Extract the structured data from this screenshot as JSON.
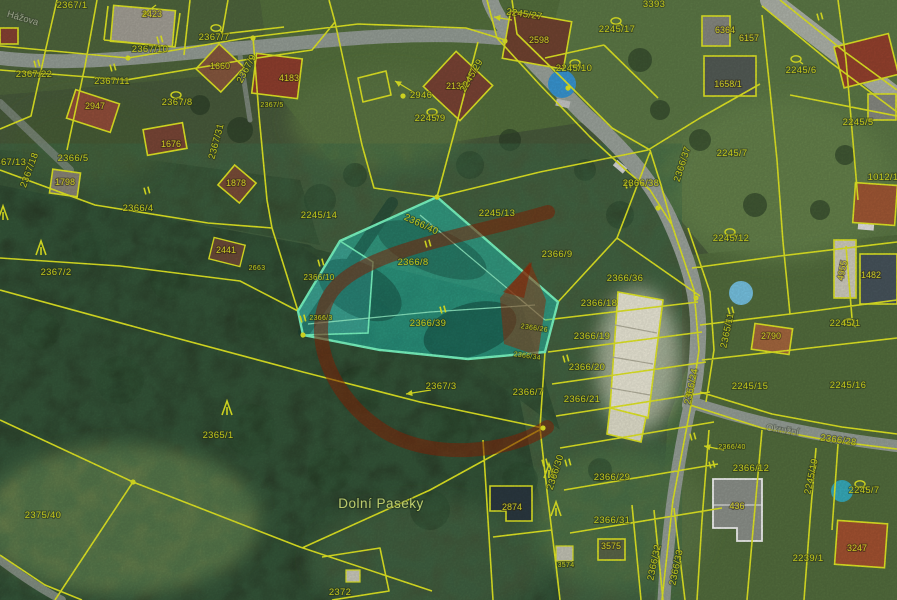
{
  "map": {
    "title": "Cadastral parcel map over aerial photo",
    "place_label": {
      "t": "Dolní Paseky",
      "x": 381,
      "y": 508
    },
    "street_labels": [
      {
        "t": "Hážova",
        "x": 22,
        "y": 21,
        "r": 16
      },
      {
        "t": "Okružní",
        "x": 782,
        "y": 433,
        "r": 9
      }
    ],
    "highlight": {
      "parcels": [
        "2366/8",
        "2366/39",
        "2366/40",
        "2366/10"
      ],
      "fill": "#1fe2d3",
      "stroke": "#7dffc8"
    },
    "colors": {
      "parcel_line": "#e9ef25",
      "parcel_text": "#dbe01f",
      "annotation_red": "#8c2405",
      "road_gray": "#9aa39b"
    },
    "parcel_labels": [
      {
        "t": "2367/1",
        "x": 72,
        "y": 8
      },
      {
        "t": "2423",
        "x": 152,
        "y": 17,
        "c": "b"
      },
      {
        "t": "2367/10",
        "x": 150,
        "y": 52
      },
      {
        "t": "2367/7",
        "x": 214,
        "y": 40
      },
      {
        "t": "2367/22",
        "x": 34,
        "y": 77
      },
      {
        "t": "2367/11",
        "x": 112,
        "y": 84
      },
      {
        "t": "2947",
        "x": 95,
        "y": 109,
        "c": "b"
      },
      {
        "t": "2367/8",
        "x": 177,
        "y": 105
      },
      {
        "t": "1660",
        "x": 220,
        "y": 69,
        "c": "b"
      },
      {
        "t": "4183",
        "x": 289,
        "y": 81,
        "c": "b"
      },
      {
        "t": "2367/5",
        "x": 272,
        "y": 107,
        "s": 7
      },
      {
        "t": "2367/9",
        "x": 249,
        "y": 70,
        "r": -62
      },
      {
        "t": "2367/31",
        "x": 219,
        "y": 142,
        "r": -75
      },
      {
        "t": "1676",
        "x": 171,
        "y": 147,
        "c": "b"
      },
      {
        "t": "2366/5",
        "x": 73,
        "y": 161
      },
      {
        "t": "1798",
        "x": 65,
        "y": 185,
        "c": "b"
      },
      {
        "t": "2367/13",
        "x": 8,
        "y": 165
      },
      {
        "t": "2367/18",
        "x": 32,
        "y": 171,
        "r": -70
      },
      {
        "t": "2366/4",
        "x": 138,
        "y": 211
      },
      {
        "t": "2367/2",
        "x": 56,
        "y": 275
      },
      {
        "t": "1878",
        "x": 236,
        "y": 186,
        "c": "b"
      },
      {
        "t": "2441",
        "x": 226,
        "y": 253,
        "c": "b"
      },
      {
        "t": "2663",
        "x": 257,
        "y": 270,
        "s": 7
      },
      {
        "t": "2365/1",
        "x": 218,
        "y": 438
      },
      {
        "t": "2375/40",
        "x": 43,
        "y": 518
      },
      {
        "t": "2245/27",
        "x": 524,
        "y": 17,
        "r": 8
      },
      {
        "t": "2598",
        "x": 539,
        "y": 43,
        "c": "b"
      },
      {
        "t": "2946",
        "x": 421,
        "y": 98
      },
      {
        "t": "2138",
        "x": 456,
        "y": 89,
        "c": "b"
      },
      {
        "t": "2245/29",
        "x": 474,
        "y": 77,
        "r": -60
      },
      {
        "t": "2245/9",
        "x": 430,
        "y": 121
      },
      {
        "t": "2245/10",
        "x": 574,
        "y": 71
      },
      {
        "t": "2245/13",
        "x": 497,
        "y": 216
      },
      {
        "t": "2245/14",
        "x": 319,
        "y": 218
      },
      {
        "t": "3393",
        "x": 654,
        "y": 7
      },
      {
        "t": "2245/17",
        "x": 617,
        "y": 32
      },
      {
        "t": "6364",
        "x": 725,
        "y": 33,
        "c": "b"
      },
      {
        "t": "6157",
        "x": 749,
        "y": 41,
        "c": "b"
      },
      {
        "t": "1658/1",
        "x": 728,
        "y": 87,
        "c": "b"
      },
      {
        "t": "2245/6",
        "x": 801,
        "y": 73
      },
      {
        "t": "2245/5",
        "x": 858,
        "y": 125
      },
      {
        "t": "1012/1",
        "x": 883,
        "y": 180
      },
      {
        "t": "2366/38",
        "x": 641,
        "y": 186
      },
      {
        "t": "2366/37",
        "x": 685,
        "y": 165,
        "r": -72
      },
      {
        "t": "2245/7",
        "x": 732,
        "y": 156
      },
      {
        "t": "2245/12",
        "x": 731,
        "y": 241
      },
      {
        "t": "2366/9",
        "x": 557,
        "y": 257
      },
      {
        "t": "2366/36",
        "x": 625,
        "y": 281
      },
      {
        "t": "2366/18",
        "x": 599,
        "y": 306
      },
      {
        "t": "2366/19",
        "x": 592,
        "y": 339
      },
      {
        "t": "2366/20",
        "x": 587,
        "y": 370
      },
      {
        "t": "2366/21",
        "x": 582,
        "y": 402
      },
      {
        "t": "2366/7",
        "x": 528,
        "y": 395
      },
      {
        "t": "2366/26",
        "x": 534,
        "y": 330,
        "r": 8,
        "s": 7
      },
      {
        "t": "2366/34",
        "x": 527,
        "y": 358,
        "r": 8,
        "s": 7
      },
      {
        "t": "2366/24",
        "x": 694,
        "y": 387,
        "r": -78
      },
      {
        "t": "2365/11",
        "x": 730,
        "y": 331,
        "r": -78
      },
      {
        "t": "2245/15",
        "x": 750,
        "y": 389
      },
      {
        "t": "2790",
        "x": 771,
        "y": 339,
        "c": "b"
      },
      {
        "t": "2245/16",
        "x": 848,
        "y": 388
      },
      {
        "t": "2245/1",
        "x": 845,
        "y": 326
      },
      {
        "t": "2366/40",
        "x": 420,
        "y": 227,
        "r": 25
      },
      {
        "t": "2366/8",
        "x": 413,
        "y": 265
      },
      {
        "t": "2366/39",
        "x": 428,
        "y": 326
      },
      {
        "t": "2366/10",
        "x": 319,
        "y": 280,
        "s": 8
      },
      {
        "t": "2366/3",
        "x": 321,
        "y": 320,
        "s": 7
      },
      {
        "t": "2367/3",
        "x": 441,
        "y": 389
      },
      {
        "t": "2366/29",
        "x": 612,
        "y": 480
      },
      {
        "t": "2366/31",
        "x": 612,
        "y": 523
      },
      {
        "t": "3575",
        "x": 611,
        "y": 549,
        "c": "b"
      },
      {
        "t": "3574",
        "x": 566,
        "y": 567,
        "s": 7
      },
      {
        "t": "2366/30",
        "x": 558,
        "y": 473,
        "r": -72
      },
      {
        "t": "2366/32",
        "x": 657,
        "y": 563,
        "r": -78
      },
      {
        "t": "2366/33",
        "x": 679,
        "y": 568,
        "r": -78
      },
      {
        "t": "2366/28",
        "x": 838,
        "y": 443,
        "r": 8
      },
      {
        "t": "2366/40",
        "x": 732,
        "y": 449,
        "s": 7
      },
      {
        "t": "2366/12",
        "x": 751,
        "y": 471
      },
      {
        "t": "436",
        "x": 737,
        "y": 509,
        "c": "b"
      },
      {
        "t": "2245/7",
        "x": 864,
        "y": 493
      },
      {
        "t": "2245/19",
        "x": 814,
        "y": 477,
        "r": -78
      },
      {
        "t": "2239/1",
        "x": 808,
        "y": 561
      },
      {
        "t": "3247",
        "x": 857,
        "y": 551,
        "c": "b"
      },
      {
        "t": "2874",
        "x": 512,
        "y": 510,
        "c": "b"
      },
      {
        "t": "2372",
        "x": 340,
        "y": 595
      },
      {
        "t": "1482",
        "x": 871,
        "y": 278,
        "c": "b"
      },
      {
        "t": "4955",
        "x": 845,
        "y": 271,
        "r": -78,
        "c": "b"
      }
    ],
    "symbols": {
      "ovals": [
        [
          216,
          28
        ],
        [
          176,
          95
        ],
        [
          432,
          112
        ],
        [
          575,
          63
        ],
        [
          796,
          59
        ],
        [
          616,
          21
        ],
        [
          730,
          232
        ],
        [
          860,
          484
        ],
        [
          849,
          322
        ]
      ],
      "grass_marks": [
        [
          160,
          40
        ],
        [
          37,
          64
        ],
        [
          113,
          68
        ],
        [
          147,
          191
        ],
        [
          303,
          319
        ],
        [
          321,
          263
        ],
        [
          428,
          244
        ],
        [
          443,
          310
        ],
        [
          628,
          185
        ],
        [
          566,
          359
        ],
        [
          545,
          463
        ],
        [
          568,
          463
        ],
        [
          693,
          437
        ],
        [
          712,
          465
        ],
        [
          820,
          17
        ],
        [
          731,
          311
        ]
      ],
      "trees": [
        [
          41,
          248
        ],
        [
          227,
          408
        ],
        [
          549,
          471
        ],
        [
          556,
          509
        ],
        [
          3,
          213
        ]
      ],
      "arrows": [
        {
          "x1": 512,
          "y1": 20,
          "x2": 494,
          "y2": 17
        },
        {
          "x1": 415,
          "y1": 93,
          "x2": 395,
          "y2": 81
        },
        {
          "x1": 431,
          "y1": 390,
          "x2": 406,
          "y2": 394
        },
        {
          "x1": 724,
          "y1": 450,
          "x2": 704,
          "y2": 446
        },
        {
          "x1": 156,
          "y1": 5,
          "x2": 142,
          "y2": 16
        }
      ],
      "survey_dots": [
        [
          505,
          41
        ],
        [
          253,
          38
        ],
        [
          128,
          58
        ],
        [
          568,
          88
        ],
        [
          658,
          208
        ],
        [
          696,
          298
        ],
        [
          688,
          394
        ],
        [
          543,
          428
        ],
        [
          303,
          335
        ],
        [
          437,
          197
        ],
        [
          133,
          482
        ],
        [
          403,
          96
        ]
      ]
    }
  }
}
